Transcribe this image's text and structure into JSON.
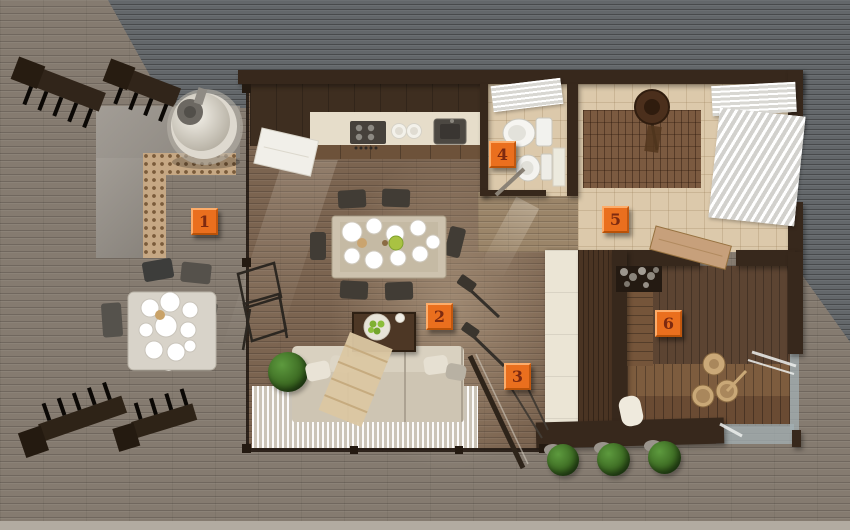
{
  "markers": [
    {
      "label": "1"
    },
    {
      "label": "2"
    },
    {
      "label": "3"
    },
    {
      "label": "4"
    },
    {
      "label": "5"
    },
    {
      "label": "6"
    }
  ],
  "palette": {
    "marker_orange": "#EA6F1E",
    "marker_digit": "#7D2A10",
    "wall_brown": "#37281C",
    "deck_gray_brown": "#857B70",
    "roof_gray": "#63676A",
    "wood_floor": "#7B6450",
    "tile_beige": "#DCC9AB",
    "sauna_wood": "#5C4432",
    "plant_green": "#3F7A2F",
    "curtain_white": "#F3F2EE"
  }
}
